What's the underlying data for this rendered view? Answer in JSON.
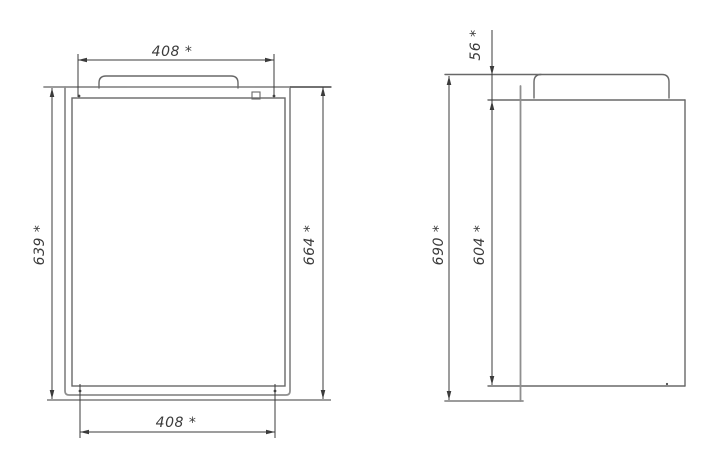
{
  "drawing": {
    "kind": "technical-dimension-drawing",
    "views": {
      "front": {
        "dims": {
          "top_width": "408 *",
          "bottom_width": "408 *",
          "left_height": "639 *",
          "right_height": "664 *"
        }
      },
      "side": {
        "dims": {
          "lid_height": "56 *",
          "overall_height": "690 *",
          "body_height": "604 *"
        }
      }
    },
    "colors": {
      "outline": "#686868",
      "plate": "#8f8f8f",
      "dimension": "#3b3b3b",
      "background": "#ffffff"
    }
  }
}
